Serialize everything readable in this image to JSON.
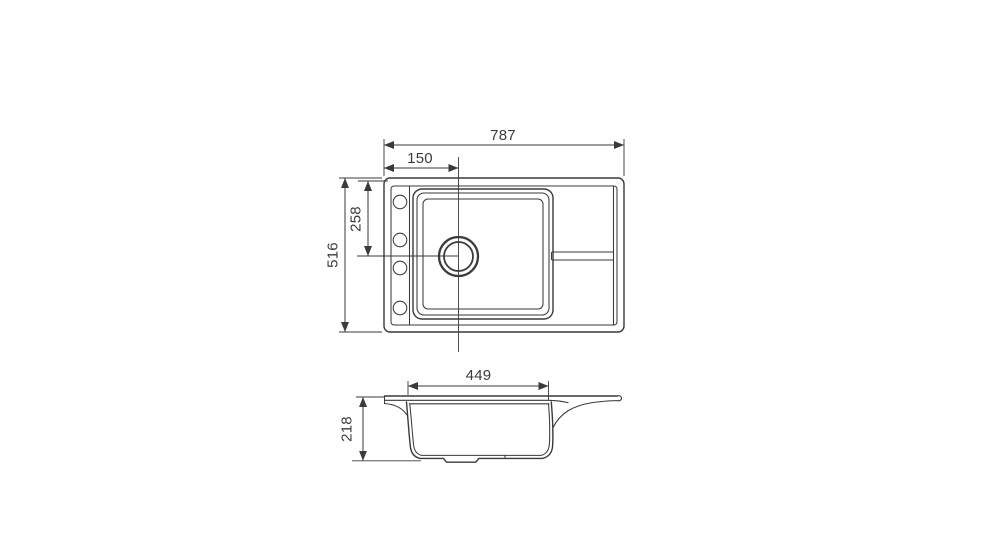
{
  "drawing": {
    "kind": "sink-technical-drawing",
    "line_color": "#3a3a3a",
    "background_color": "#ffffff",
    "views": {
      "top": "top view",
      "section": "front section view"
    },
    "dimensions": {
      "overall_width": "787",
      "drain_offset_x": "150",
      "drain_offset_y": "258",
      "overall_depth": "516",
      "bowl_width": "449",
      "bowl_depth": "218"
    },
    "features": {
      "tap_holes": 4,
      "drain": "circular drain with flange",
      "accessory_rail": "horizontal groove on drainboard side"
    }
  }
}
